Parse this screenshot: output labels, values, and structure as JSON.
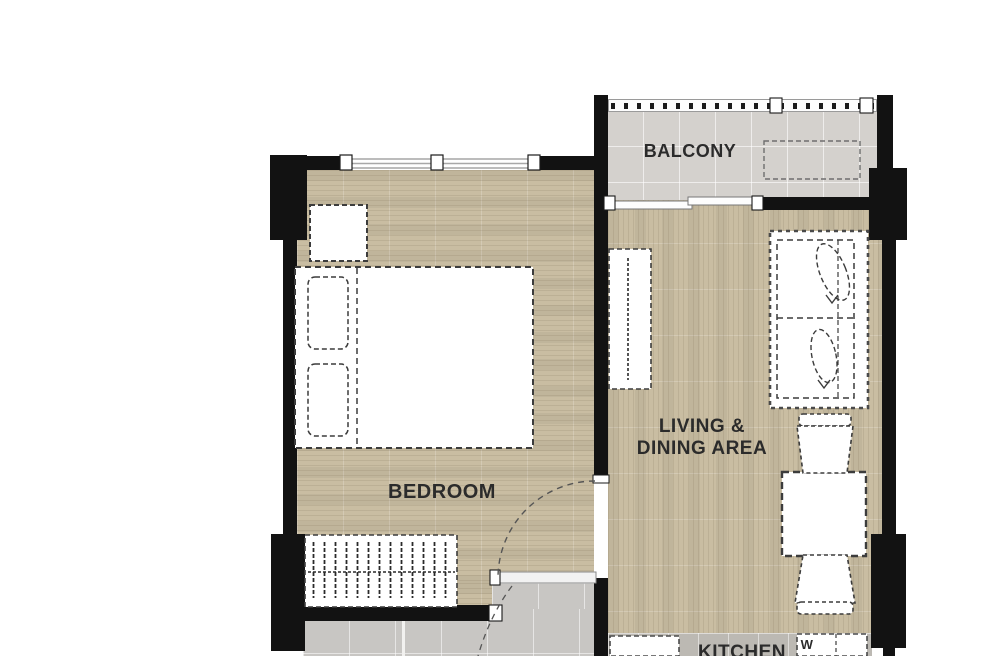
{
  "rooms": {
    "balcony": {
      "label": "BALCONY"
    },
    "bedroom": {
      "label": "BEDROOM"
    },
    "living": {
      "line1": "LIVING &",
      "line2": "DINING AREA"
    },
    "kitchen": {
      "label": "KITCHEN"
    }
  },
  "fixtures": {
    "washer_label": "W"
  },
  "colors": {
    "wall": "#121212",
    "wood_floor": "#c9bda2",
    "balcony_tile": "#d4d1cd",
    "bath_tile": "#c8c6c3",
    "kitchen_tile": "#bcb9b3",
    "furniture_outline": "#3c3c3c",
    "label_text": "#2b2b2b"
  }
}
